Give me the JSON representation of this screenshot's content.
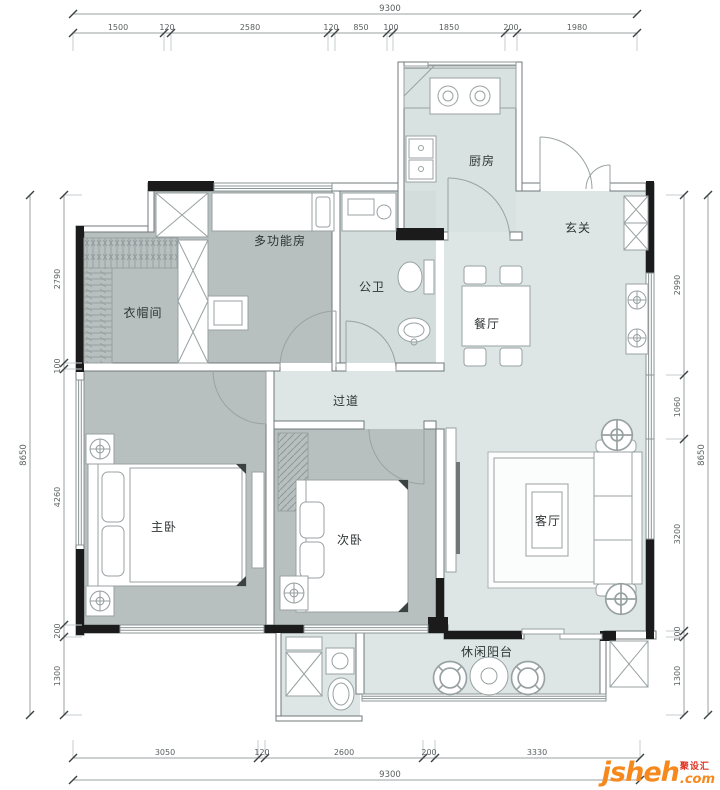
{
  "rooms": {
    "kitchen": "厨房",
    "entry": "玄关",
    "dining": "餐厅",
    "bath": "公卫",
    "multi": "多功能房",
    "cloak": "衣帽间",
    "corridor": "过道",
    "master": "主卧",
    "second": "次卧",
    "living": "客厅",
    "balcony": "休闲阳台"
  },
  "dims": {
    "top_overall": "9300",
    "top": [
      "1500",
      "120",
      "2580",
      "120",
      "850",
      "100",
      "1850",
      "200",
      "1980"
    ],
    "bottom_overall": "9300",
    "bottom": [
      "3050",
      "120",
      "2600",
      "200",
      "3330"
    ],
    "left_overall": "8650",
    "left": [
      "2790",
      "100",
      "4260",
      "200",
      "1300"
    ],
    "right_overall": "8650",
    "right": [
      "2990",
      "1060",
      "3200",
      "100",
      "1300"
    ]
  },
  "logo": {
    "brand": "jsheh",
    "suffix": ".com",
    "tagline": "聚设汇"
  },
  "colors": {
    "wall_black": "#1b1b1b",
    "floor_public": "#dde6e5",
    "floor_bedroom": "#b7bfbf",
    "floor_bath": "#d2dddc",
    "floor_kitchen": "#d8e2e1",
    "logo_orange": "#f6891e",
    "logo_red": "#e0301e"
  }
}
